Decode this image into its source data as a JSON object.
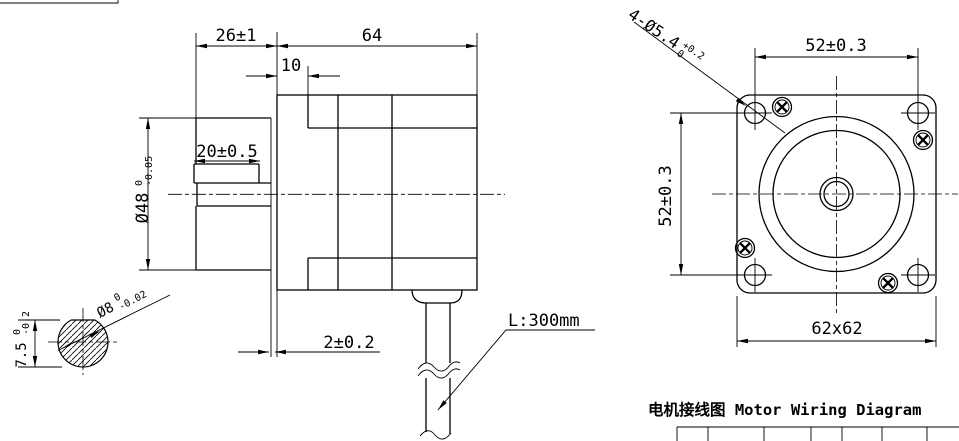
{
  "side_view": {
    "dims": {
      "front_length": "26±1",
      "body_length": "64",
      "step": "10",
      "flat_length": "20±0.5",
      "pilot_dia": {
        "value": "Ø48",
        "upper": "0",
        "lower": "-0.05"
      },
      "flange_thickness": "2±0.2",
      "cable_length": "L:300mm",
      "shaft_dia": {
        "value": "Ø8",
        "upper": "0",
        "lower": "-0.02"
      },
      "shaft_flat": {
        "value": "7.5",
        "upper": "0",
        "lower": "-0.2"
      }
    }
  },
  "front_view": {
    "dims": {
      "hole_spacing_h": "52±0.3",
      "hole_spacing_v": "52±0.3",
      "flange_size": "62x62",
      "mounting_holes": {
        "value": "4-Ø5.4",
        "upper": "+0.2",
        "lower": "0"
      }
    }
  },
  "wiring": {
    "title": "电机接线图 Motor Wiring Diagram"
  },
  "colors": {
    "line": "#000000",
    "background": "#ffffff"
  }
}
